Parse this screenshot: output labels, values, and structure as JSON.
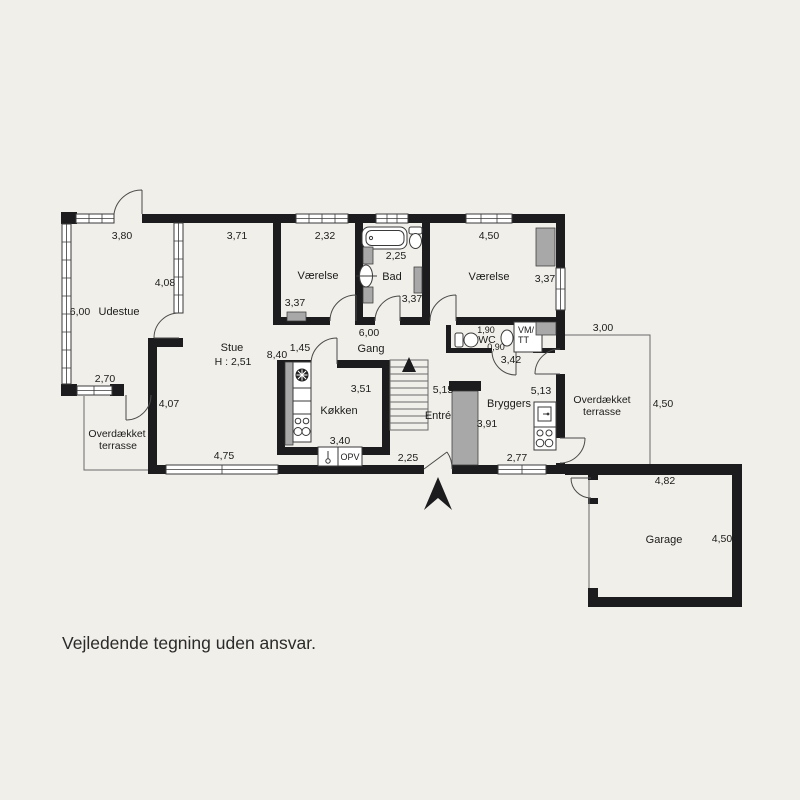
{
  "colors": {
    "background": "#f0efe9",
    "walls": "#1c1c1e",
    "fixture_gray": "#a8a8a8",
    "thin_line": "#4a4a4a",
    "text": "#1b1b1b"
  },
  "note": {
    "disclaimer": "Vejledende tegning uden ansvar."
  },
  "rooms": {
    "udestue": "Udestue",
    "stue": "Stue",
    "stue_height": "H : 2,51",
    "vaerelse_1": "Værelse",
    "bad": "Bad",
    "vaerelse_2": "Værelse",
    "gang": "Gang",
    "koekken": "Køkken",
    "entre": "Entré",
    "wc": "WC",
    "vm_line1": "VM/",
    "vm_line2": "TT",
    "bryggers": "Bryggers",
    "garage": "Garage",
    "terrasse_line1": "Overdækket",
    "terrasse_line2": "terrasse",
    "opv": "OPV"
  },
  "dims": {
    "udestue_width": "3,80",
    "udestue_depth": "6,00",
    "udestue_window_east": "4,08",
    "udestue_window_south": "2,70",
    "stue_top": "3,71",
    "stue_width": "8,40",
    "stue_passage": "1,45",
    "stue_west": "4,07",
    "stue_window_south": "4,75",
    "vaerelse1_width": "2,32",
    "vaerelse1_depth": "3,37",
    "bad_width": "2,25",
    "bad_depth": "3,37",
    "vaerelse2_width": "4,50",
    "vaerelse2_depth": "3,37",
    "gang_length": "6,00",
    "wc_width": "1,90",
    "wc_depth": "0,90",
    "bryggers_north": "3,42",
    "koekken_depth": "3,51",
    "koekken_width": "3,40",
    "entre_length": "5,15",
    "front_door": "2,25",
    "bryggers_east": "5,13",
    "bryggers_west": "3,91",
    "bryggers_window": "2,77",
    "terrasse_width": "3,00",
    "terrasse_depth": "4,50",
    "garage_width": "4,82",
    "garage_depth": "4,50"
  }
}
